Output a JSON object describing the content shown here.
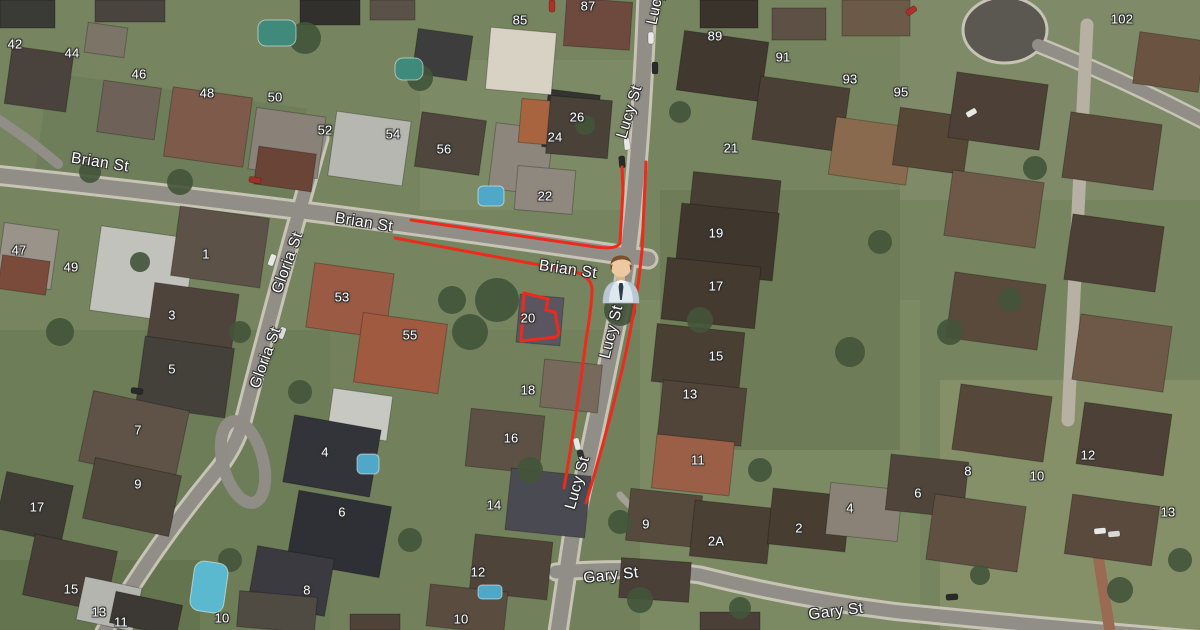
{
  "map": {
    "view": "satellite",
    "route_color": "#ee2a1c",
    "highlighted_property_number": "20",
    "marker": {
      "name": "person-marker",
      "icon": "businessman-icon"
    },
    "street_labels": [
      {
        "text": "Brian St",
        "x": 100,
        "y": 163,
        "rot": 9
      },
      {
        "text": "Brian St",
        "x": 364,
        "y": 223,
        "rot": 9
      },
      {
        "text": "Brian St",
        "x": 568,
        "y": 270,
        "rot": 8
      },
      {
        "text": "Gloria St",
        "x": 288,
        "y": 263,
        "rot": -70
      },
      {
        "text": "Gloria St",
        "x": 266,
        "y": 358,
        "rot": -70
      },
      {
        "text": "Lucy St",
        "x": 658,
        "y": -2,
        "rot": -78
      },
      {
        "text": "Lucy St",
        "x": 630,
        "y": 112,
        "rot": -73
      },
      {
        "text": "Lucy St",
        "x": 612,
        "y": 332,
        "rot": -76
      },
      {
        "text": "Lucy St",
        "x": 578,
        "y": 483,
        "rot": -74
      },
      {
        "text": "Gary St",
        "x": 611,
        "y": 576,
        "rot": -6
      },
      {
        "text": "Gary St",
        "x": 836,
        "y": 612,
        "rot": -7
      }
    ],
    "house_numbers": [
      {
        "text": "42",
        "x": 15,
        "y": 44
      },
      {
        "text": "44",
        "x": 72,
        "y": 53
      },
      {
        "text": "46",
        "x": 139,
        "y": 74
      },
      {
        "text": "48",
        "x": 207,
        "y": 93
      },
      {
        "text": "50",
        "x": 275,
        "y": 97
      },
      {
        "text": "52",
        "x": 325,
        "y": 130
      },
      {
        "text": "54",
        "x": 393,
        "y": 134
      },
      {
        "text": "56",
        "x": 444,
        "y": 149
      },
      {
        "text": "85",
        "x": 520,
        "y": 20
      },
      {
        "text": "87",
        "x": 588,
        "y": 6
      },
      {
        "text": "89",
        "x": 715,
        "y": 36
      },
      {
        "text": "91",
        "x": 783,
        "y": 57
      },
      {
        "text": "93",
        "x": 850,
        "y": 79
      },
      {
        "text": "95",
        "x": 901,
        "y": 92
      },
      {
        "text": "102",
        "x": 1122,
        "y": 19
      },
      {
        "text": "26",
        "x": 577,
        "y": 117
      },
      {
        "text": "24",
        "x": 555,
        "y": 137
      },
      {
        "text": "22",
        "x": 545,
        "y": 196
      },
      {
        "text": "21",
        "x": 731,
        "y": 148
      },
      {
        "text": "19",
        "x": 716,
        "y": 233
      },
      {
        "text": "17",
        "x": 716,
        "y": 286
      },
      {
        "text": "15",
        "x": 716,
        "y": 356
      },
      {
        "text": "13",
        "x": 690,
        "y": 394
      },
      {
        "text": "11",
        "x": 698,
        "y": 460
      },
      {
        "text": "9",
        "x": 646,
        "y": 524
      },
      {
        "text": "2A",
        "x": 716,
        "y": 541
      },
      {
        "text": "2",
        "x": 799,
        "y": 528
      },
      {
        "text": "4",
        "x": 850,
        "y": 508
      },
      {
        "text": "6",
        "x": 918,
        "y": 493
      },
      {
        "text": "8",
        "x": 968,
        "y": 471
      },
      {
        "text": "10",
        "x": 1037,
        "y": 476
      },
      {
        "text": "12",
        "x": 1088,
        "y": 455
      },
      {
        "text": "13",
        "x": 1168,
        "y": 512
      },
      {
        "text": "47",
        "x": 19,
        "y": 250
      },
      {
        "text": "49",
        "x": 71,
        "y": 267
      },
      {
        "text": "1",
        "x": 206,
        "y": 254
      },
      {
        "text": "3",
        "x": 172,
        "y": 315
      },
      {
        "text": "5",
        "x": 172,
        "y": 369
      },
      {
        "text": "53",
        "x": 342,
        "y": 297
      },
      {
        "text": "55",
        "x": 410,
        "y": 335
      },
      {
        "text": "20",
        "x": 528,
        "y": 318
      },
      {
        "text": "18",
        "x": 528,
        "y": 390
      },
      {
        "text": "16",
        "x": 511,
        "y": 438
      },
      {
        "text": "14",
        "x": 494,
        "y": 505
      },
      {
        "text": "12",
        "x": 478,
        "y": 572
      },
      {
        "text": "10",
        "x": 461,
        "y": 619
      },
      {
        "text": "7",
        "x": 138,
        "y": 430
      },
      {
        "text": "9",
        "x": 138,
        "y": 484
      },
      {
        "text": "17",
        "x": 37,
        "y": 507
      },
      {
        "text": "15",
        "x": 71,
        "y": 589
      },
      {
        "text": "13",
        "x": 99,
        "y": 612
      },
      {
        "text": "11",
        "x": 121,
        "y": 622
      },
      {
        "text": "4",
        "x": 325,
        "y": 452
      },
      {
        "text": "6",
        "x": 342,
        "y": 512
      },
      {
        "text": "8",
        "x": 307,
        "y": 590
      },
      {
        "text": "10",
        "x": 222,
        "y": 618
      }
    ]
  }
}
